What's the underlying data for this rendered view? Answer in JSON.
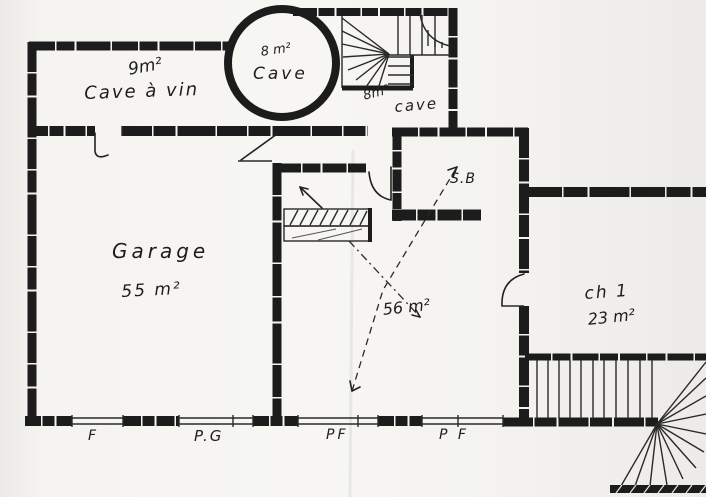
{
  "document": {
    "kind": "hand-drawn floor plan (scanned sketch)",
    "ink_color": "#1c1c1c",
    "paper_color": "#f5f4f0"
  },
  "labels": {
    "cave_a_vin_area": "9m²",
    "cave_a_vin_name": "Cave à vin",
    "turret_area": "8 m²",
    "turret_name": "Cave",
    "small_cave_area": "8m²",
    "small_cave_name": "cave",
    "sb_name": "S.B",
    "garage_name": "Garage",
    "garage_area": "55 m²",
    "main_area": "56 m²",
    "ch1_name": "ch 1",
    "ch1_area": "23 m²"
  },
  "openings": {
    "f": "F",
    "pg": "P.G",
    "pf1": "PF",
    "pf2": "P F"
  }
}
